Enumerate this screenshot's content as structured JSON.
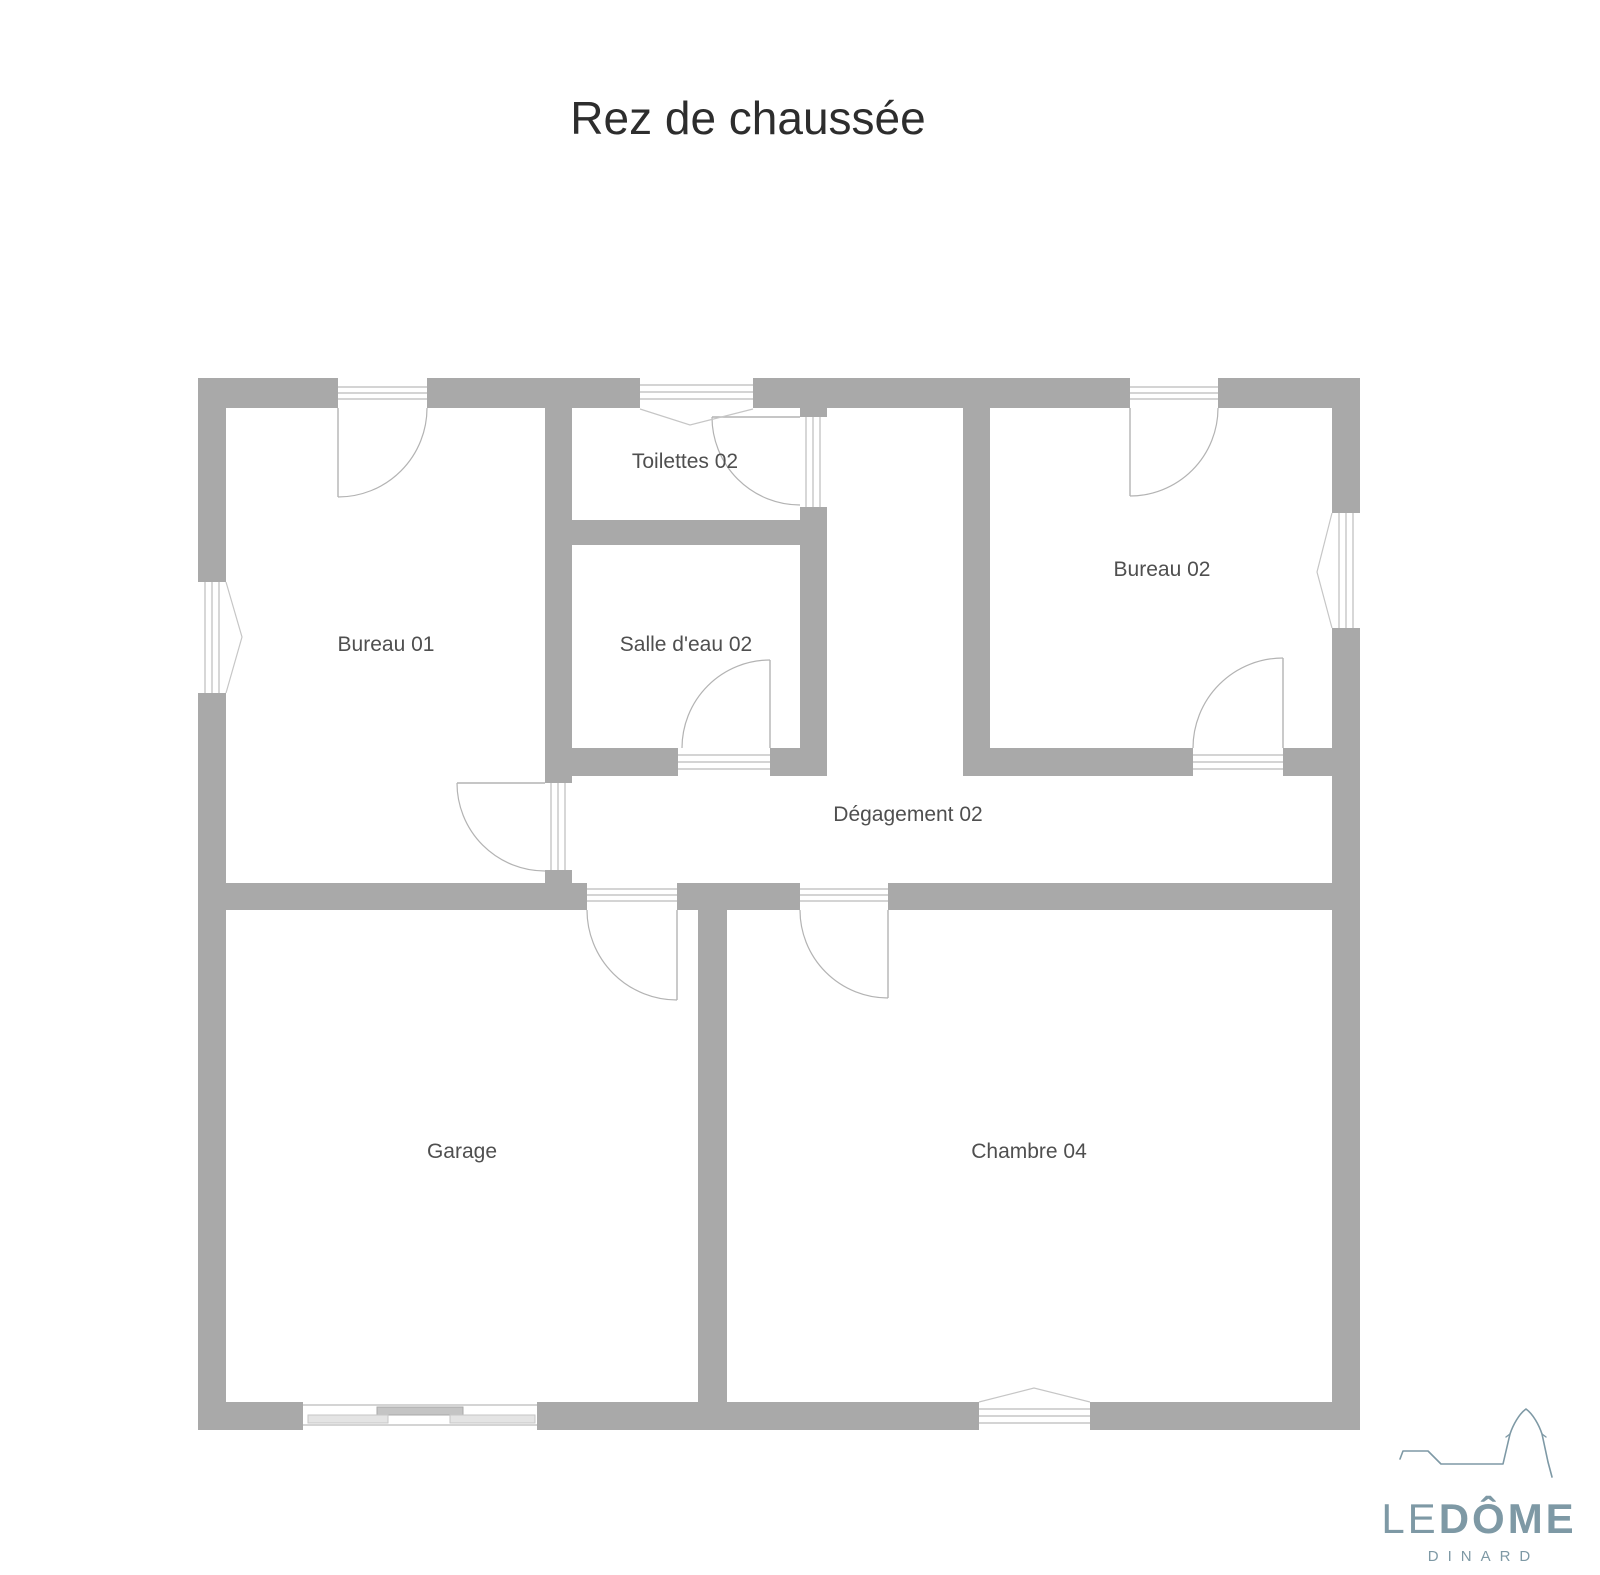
{
  "page": {
    "title": "Rez de chaussée"
  },
  "rooms": {
    "bureau01": "Bureau 01",
    "toilettes02": "Toilettes 02",
    "salledeau02": "Salle d'eau 02",
    "bureau02": "Bureau 02",
    "degagement02": "Dégagement 02",
    "garage": "Garage",
    "chambre04": "Chambre 04"
  },
  "logo": {
    "name_light": "LE",
    "name_bold": "DÔME",
    "subtitle": "DINARD"
  },
  "colors": {
    "wall": "#a9a9a9",
    "line-light": "#c6c6c6",
    "line-mid": "#b3b3b3",
    "room-label": "#4f4f4f",
    "title": "#2d2d2d",
    "accent": "#7e99a5",
    "bg": "#ffffff",
    "panel-dark": "#c4c4c4",
    "panel-light": "#e4e4e4"
  }
}
